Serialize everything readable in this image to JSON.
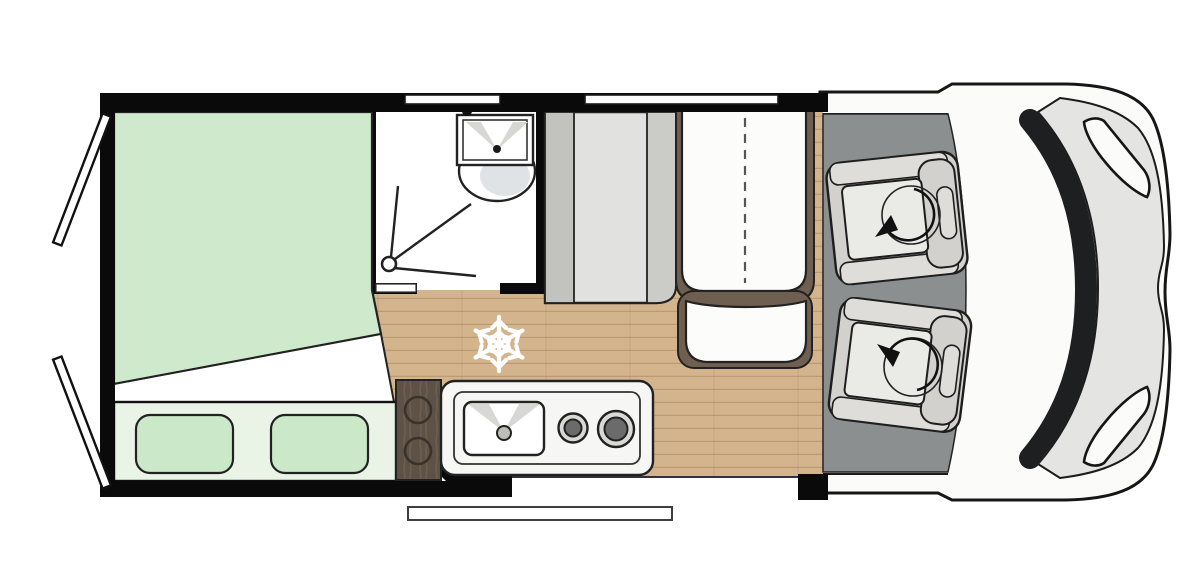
{
  "title": "Camper van floor plan (top view)",
  "colors": {
    "background": "#ffffff",
    "outline": "#1f1f1f",
    "wall": "#0a0a0a",
    "van_body": "#fbfbfa",
    "hood": "#e4e4e2",
    "windshield": "#1d1f20",
    "cab_floor": "#8b8f90",
    "seat_base": "#d2d1ce",
    "seat_band": "#deddda",
    "seat_cushion": "#eaeae7",
    "wood_floor": "#d4b48c",
    "wood_plank_line": "#a8845c",
    "dark_wood": "#5e5247",
    "dark_wood_streak": "#7a6c5d",
    "mattress": "#cfe9cc",
    "fold_white": "#ffffff",
    "pillow_panel": "#e9f4e7",
    "pillow": "#cbe8c8",
    "bathroom_floor": "#ffffff",
    "fixture_shade": "#d7d7d5",
    "toilet_shade": "#dfe3e5",
    "wardrobe_side": "#c2c2bf",
    "wardrobe_mid": "#e1e1df",
    "wardrobe_side2": "#cbcbc8",
    "bench": "#fcfcfb",
    "bench_trim": "#6e5f50",
    "counter": "#f6f6f4",
    "sink": "#ffffff",
    "faucet": "#bdbdbb",
    "burner_ring": "#d9d9d7",
    "burner_center": "#6b6b6b",
    "knob_stroke": "#3a332b",
    "step": "#ffffff",
    "snowflake": "#ffffff",
    "window": "#ffffff",
    "door_leaf": "#ffffff",
    "arrow": "#111111"
  },
  "icons": {
    "snowflake": {
      "name": "snowflake-icon",
      "shape": "six-spoke snowflake on floor"
    },
    "swivel_arrow": {
      "name": "rotation-arrow-icon",
      "shape": "circular arc with solid arrowhead"
    },
    "shower_drain": {
      "name": "shower-drain-icon",
      "shape": "circle with three spray lines"
    },
    "burner": {
      "name": "burner-icon",
      "shape": "concentric circles"
    }
  },
  "areas": {
    "bed": "rear-bed",
    "bathroom": "shower-room",
    "wardrobe": "wardrobe-cabinet",
    "bench": "travel-bench-2-seats",
    "kitchen": "kitchen-block",
    "cab": "driver-cab-swivel-seats",
    "entry": "sliding-door-entry-step",
    "rear": "rear-doors-open"
  }
}
